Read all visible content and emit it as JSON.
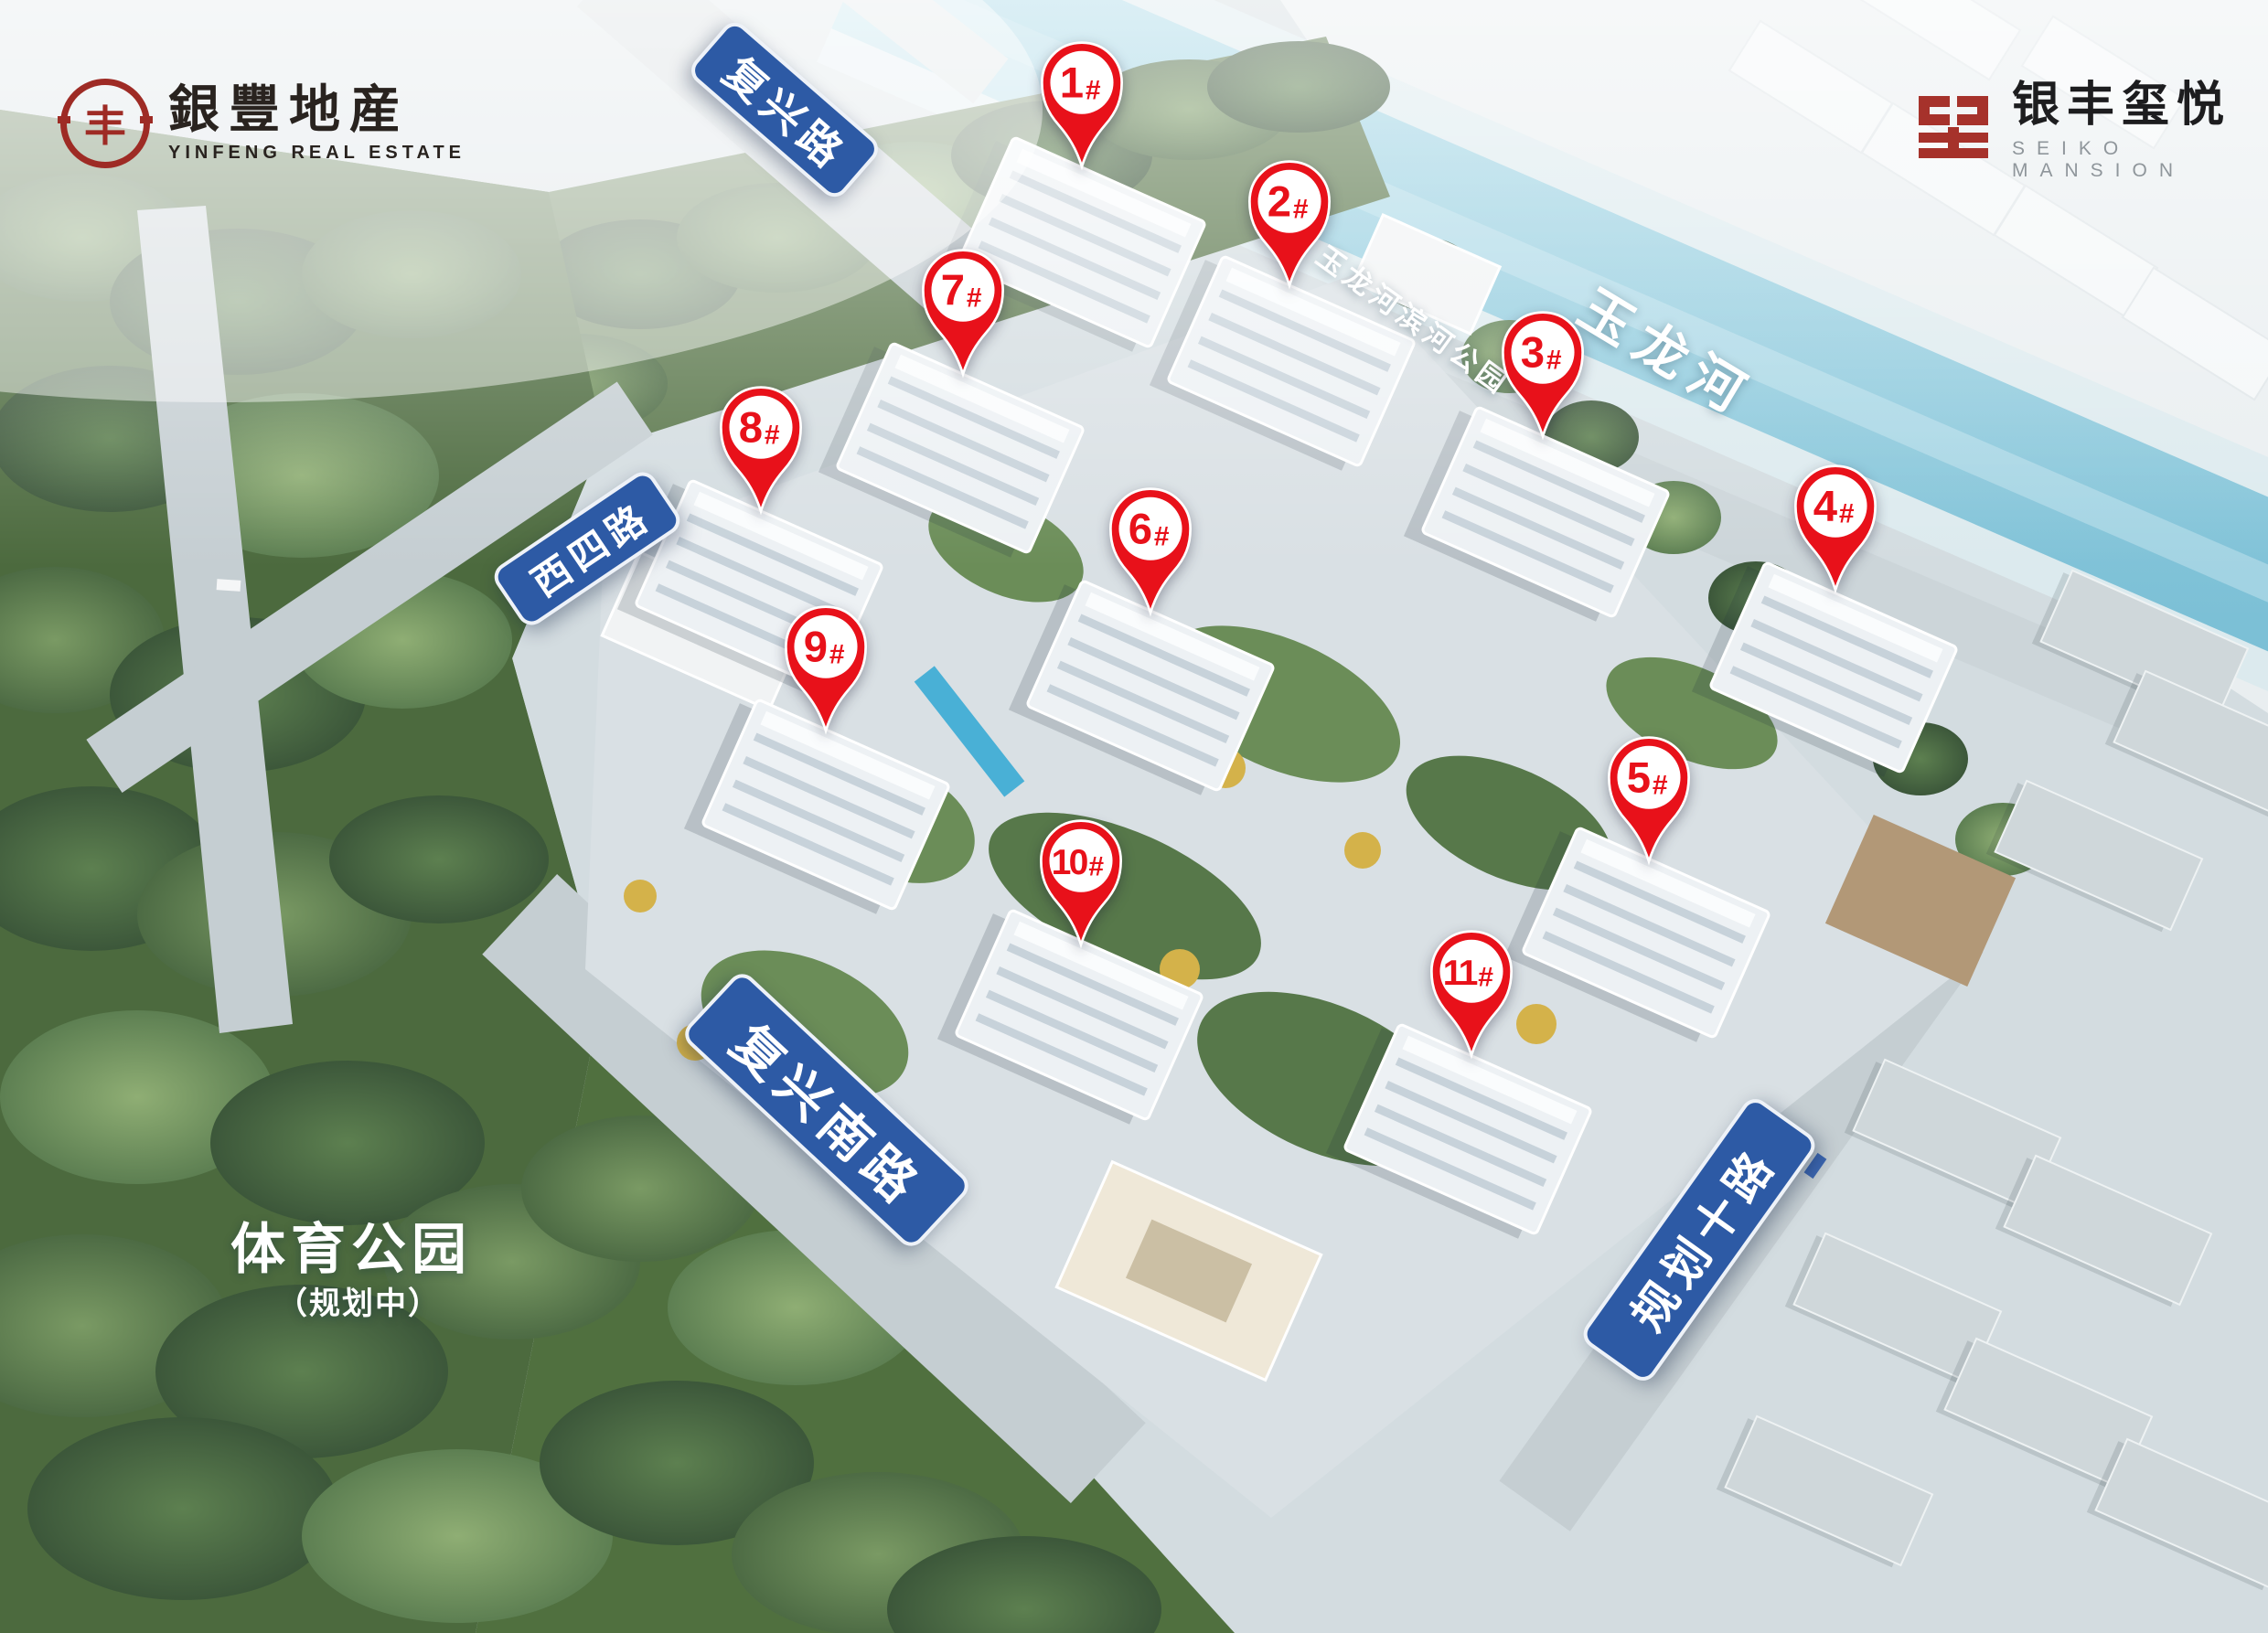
{
  "branding": {
    "yinfeng": {
      "name_cn": "銀豐地産",
      "name_en": "YINFENG REAL ESTATE",
      "seal_glyph": "丰",
      "logo_color": "#9e2b25"
    },
    "project": {
      "name_cn": "银丰玺悦",
      "name_en": "SEIKO MANSION",
      "logo_color": "#a6322b"
    }
  },
  "map": {
    "roads": [
      {
        "id": "fuxing",
        "name": "复兴路"
      },
      {
        "id": "xisi",
        "name": "西四路"
      },
      {
        "id": "fuxing-south",
        "name": "复兴南路"
      },
      {
        "id": "planned-10",
        "name": "规划十路"
      }
    ],
    "water": {
      "river_name": "玉龙河"
    },
    "parks": {
      "riverside": "玉龙河滨河公园",
      "sports": "体育公园",
      "sports_note": "（规划中）"
    },
    "markers": [
      {
        "label": "1#",
        "num": "1",
        "suffix": "#"
      },
      {
        "label": "2#",
        "num": "2",
        "suffix": "#"
      },
      {
        "label": "3#",
        "num": "3",
        "suffix": "#"
      },
      {
        "label": "4#",
        "num": "4",
        "suffix": "#"
      },
      {
        "label": "5#",
        "num": "5",
        "suffix": "#"
      },
      {
        "label": "6#",
        "num": "6",
        "suffix": "#"
      },
      {
        "label": "7#",
        "num": "7",
        "suffix": "#"
      },
      {
        "label": "8#",
        "num": "8",
        "suffix": "#"
      },
      {
        "label": "9#",
        "num": "9",
        "suffix": "#"
      },
      {
        "label": "10#",
        "num": "10",
        "suffix": "#"
      },
      {
        "label": "11#",
        "num": "11",
        "suffix": "#"
      }
    ]
  },
  "colors": {
    "marker_red": "#e8111a",
    "road_sign_blue": "#2d5aa5",
    "river_blue": "#8cc8da",
    "forest_green": "#50703f",
    "label_white": "#ffffff"
  }
}
